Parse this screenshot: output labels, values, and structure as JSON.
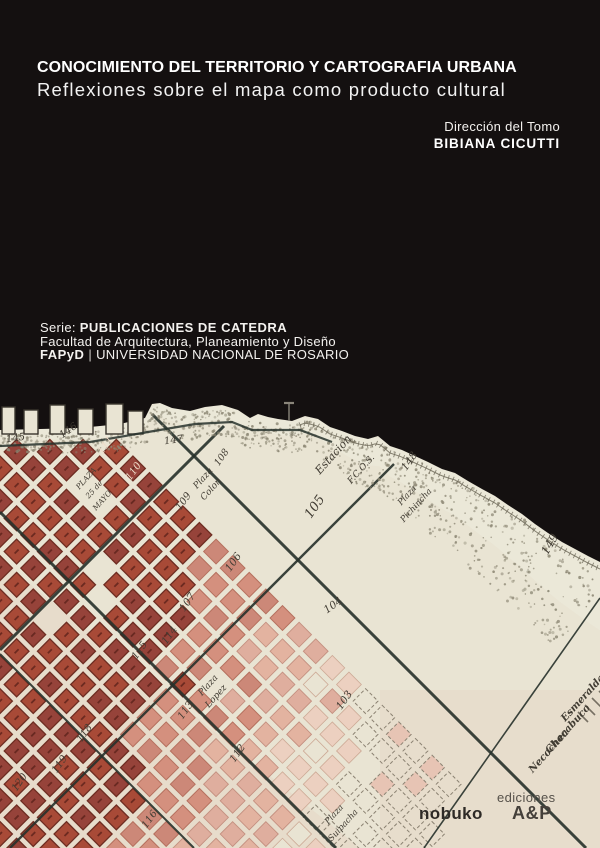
{
  "cover": {
    "title_line1": "CONOCIMIENTO DEL TERRITORIO Y CARTOGRAFIA URBANA",
    "title_line2": "Reflexiones sobre el mapa como producto cultural",
    "direction_label": "Dirección del Tomo",
    "direction_name": "BIBIANA CICUTTI",
    "series_prefix": "Serie:",
    "series_name": "PUBLICACIONES DE CATEDRA",
    "series_faculty": "Facultad de Arquitectura, Planeamiento y Diseño",
    "series_acronym": "FAPyD",
    "series_separator": "|",
    "series_university": "UNIVERSIDAD NACIONAL DE ROSARIO"
  },
  "publisher": {
    "imprint": "nobuko",
    "ediciones_label": "ediciones",
    "logo": "A&P"
  },
  "colors": {
    "background": "#141010",
    "title": "#ffffff",
    "paper": "#e9e4d3",
    "shore": "#ebe8da",
    "block_dark": "#a84a37",
    "block_dark2": "#96433a",
    "block_dark_stroke": "#6e2d22",
    "block_mid": "#d4907e",
    "block_mid_stroke": "#b5705e",
    "block_light": "#e3b3a0",
    "block_light_stroke": "#c49080",
    "block_faint": "#ecd0c0",
    "block_faint_stroke": "#cdaa96",
    "outline": "#8b8272",
    "street": "#27312b",
    "hatch": "#716c5c",
    "stipple": "#8d8875",
    "label": "#413c33",
    "label_light": "#eedbc8",
    "publisher_dark": "#2e2a26",
    "publisher_gray": "#56514a"
  },
  "map": {
    "labels": [
      {
        "t": "145",
        "x": 16,
        "y": 441,
        "r": -8,
        "s": 10
      },
      {
        "t": "146",
        "x": 70,
        "y": 433,
        "r": -35,
        "s": 10
      },
      {
        "t": "147",
        "x": 174,
        "y": 443,
        "r": -8,
        "s": 10
      },
      {
        "t": "148",
        "x": 412,
        "y": 463,
        "r": -55,
        "s": 10.5
      },
      {
        "t": "149",
        "x": 553,
        "y": 546,
        "r": -60,
        "s": 11.5
      },
      {
        "t": "111",
        "x": 108,
        "y": 447,
        "r": -55,
        "s": 10,
        "k": "light"
      },
      {
        "t": "110",
        "x": 136,
        "y": 473,
        "r": -55,
        "s": 10,
        "k": "light"
      },
      {
        "t": "108",
        "x": 224,
        "y": 459,
        "r": -55,
        "s": 9.5
      },
      {
        "t": "109",
        "x": 186,
        "y": 503,
        "r": -55,
        "s": 10
      },
      {
        "t": "105",
        "x": 318,
        "y": 509,
        "r": -55,
        "s": 13
      },
      {
        "t": "106",
        "x": 236,
        "y": 564,
        "r": -55,
        "s": 10.5
      },
      {
        "t": "107",
        "x": 190,
        "y": 604,
        "r": -55,
        "s": 10.5
      },
      {
        "t": "104",
        "x": 335,
        "y": 608,
        "r": -35,
        "s": 10.5
      },
      {
        "t": "114",
        "x": 172,
        "y": 637,
        "r": -55,
        "s": 10
      },
      {
        "t": "115",
        "x": 142,
        "y": 652,
        "r": -55,
        "s": 10
      },
      {
        "t": "113",
        "x": 188,
        "y": 712,
        "r": -55,
        "s": 10
      },
      {
        "t": "103",
        "x": 347,
        "y": 702,
        "r": -55,
        "s": 10.5
      },
      {
        "t": "112",
        "x": 240,
        "y": 755,
        "r": -55,
        "s": 10
      },
      {
        "t": "118",
        "x": 87,
        "y": 735,
        "r": -55,
        "s": 10
      },
      {
        "t": "119",
        "x": 62,
        "y": 766,
        "r": -55,
        "s": 10
      },
      {
        "t": "120",
        "x": 22,
        "y": 784,
        "r": -55,
        "s": 10
      },
      {
        "t": "116",
        "x": 152,
        "y": 821,
        "r": -55,
        "s": 10
      },
      {
        "t": "PLAZA",
        "x": 88,
        "y": 480,
        "r": -48,
        "s": 7.5
      },
      {
        "t": "25 de",
        "x": 96,
        "y": 491,
        "r": -48,
        "s": 7.5
      },
      {
        "t": "MAYO",
        "x": 104,
        "y": 502,
        "r": -48,
        "s": 7.5
      },
      {
        "t": "Plaza",
        "x": 205,
        "y": 480,
        "r": -48,
        "s": 9
      },
      {
        "t": "Colon",
        "x": 213,
        "y": 491,
        "r": -48,
        "s": 9
      },
      {
        "t": "Estacion",
        "x": 336,
        "y": 457,
        "r": -48,
        "s": 11
      },
      {
        "t": "F.C.O.S.",
        "x": 363,
        "y": 471,
        "r": -48,
        "s": 9
      },
      {
        "t": "Plaza",
        "x": 409,
        "y": 497,
        "r": -48,
        "s": 8.5
      },
      {
        "t": "Pichincha",
        "x": 418,
        "y": 507,
        "r": -48,
        "s": 8.5
      },
      {
        "t": "Plaza",
        "x": 210,
        "y": 687,
        "r": -48,
        "s": 9
      },
      {
        "t": "Lopez",
        "x": 218,
        "y": 698,
        "r": -48,
        "s": 9
      },
      {
        "t": "Plaza",
        "x": 336,
        "y": 816,
        "r": -48,
        "s": 8.5
      },
      {
        "t": "Suipacha",
        "x": 345,
        "y": 827,
        "r": -48,
        "s": 8.5
      },
      {
        "t": "Esmeralda",
        "x": 585,
        "y": 700,
        "r": -48,
        "s": 10,
        "k": "street"
      },
      {
        "t": "Chacabuco",
        "x": 570,
        "y": 731,
        "r": -48,
        "s": 10,
        "k": "street"
      },
      {
        "t": "Necochea",
        "x": 551,
        "y": 753,
        "r": -48,
        "s": 10,
        "k": "street"
      }
    ]
  }
}
